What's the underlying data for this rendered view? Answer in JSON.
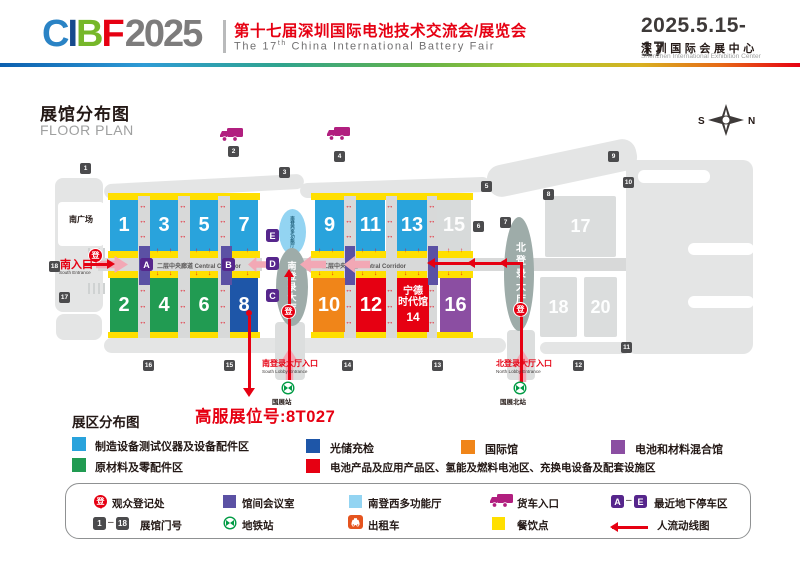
{
  "colors": {
    "brand_red": "#E60012",
    "hall_blue": "#29A3DC",
    "hall_green": "#219B52",
    "hall_dark_blue": "#1E56A8",
    "hall_orange": "#F08519",
    "hall_red": "#E60012",
    "hall_purple": "#8B4EA2",
    "hall_gray": "#DBDDDD",
    "dining_yellow": "#FFDF00",
    "meeting_purple": "#5B51A4",
    "parking_purple": "#56268C",
    "multi_blue": "#93D4F2",
    "metro_green": "#009B44",
    "taxi_orange": "#E5541F",
    "truck_magenta": "#B11F7F",
    "gate_gray": "#4B4B4D",
    "corridor_gray": "#D8D9D9",
    "lobby_gray": "#9EACA9"
  },
  "header": {
    "logo_c": "C",
    "logo_i": "I",
    "logo_b": "B",
    "logo_f": "F",
    "logo_year": "2025",
    "title_cn": "第十七届深圳国际电池技术交流会/展览会",
    "title_en_pre": "The 17",
    "title_en_sup": "th",
    "title_en_post": " China International Battery Fair",
    "dates": "2025.5.15-17",
    "venue_cn": "深圳国际会展中心",
    "venue_en": "Shenzhen International Exhibition Center"
  },
  "floorplan": {
    "title_cn": "展馆分布图",
    "title_en": "FLOOR PLAN",
    "compass_s": "S",
    "compass_n": "N",
    "south_square": "南广场",
    "corridor_left": "二层中央廊道 Central Corridor",
    "corridor_right": "二层中央廊道 Central Corridor",
    "south_lobby": "南登录大厅",
    "north_lobby": "北登录大厅",
    "multi_hall": "南登西多功能厅",
    "reg_glyph": "登",
    "south_entrance_cn": "南入口",
    "south_entrance_en": "South Entrance",
    "south_lobby_entrance_cn": "南登录大厅入口",
    "south_lobby_entrance_en": "South Lobby Entrance",
    "north_lobby_entrance_cn": "北登录大厅入口",
    "north_lobby_entrance_en": "North Lobby Entrance",
    "station_south": "国展站",
    "station_north": "国展北站",
    "booth_callout": "高服展位号:8T027",
    "halls": {
      "h1": "1",
      "h2": "2",
      "h3": "3",
      "h4": "4",
      "h5": "5",
      "h6": "6",
      "h7": "7",
      "h8": "8",
      "h9": "9",
      "h10": "10",
      "h11": "11",
      "h12": "12",
      "h13": "13",
      "h15": "15",
      "h16": "16",
      "h17": "17",
      "h18": "18",
      "h20": "20",
      "h14_l1": "宁德",
      "h14_l2": "时代馆",
      "h14_no": "14"
    },
    "gates": {
      "g1": "1",
      "g2": "2",
      "g3": "3",
      "g4": "4",
      "g5": "5",
      "g6": "6",
      "g7": "7",
      "g8": "8",
      "g9": "9",
      "g10": "10",
      "g11": "11",
      "g12": "12",
      "g13": "13",
      "g14": "14",
      "g15": "15",
      "g16": "16",
      "g17": "17",
      "g18": "18"
    },
    "parking": {
      "a": "A",
      "b": "B",
      "c": "C",
      "d": "D",
      "e": "E"
    }
  },
  "legend": {
    "heading": "展区分布图",
    "zones": [
      {
        "label": "制造设备测试仪器及设备配件区",
        "color": "#29A3DC"
      },
      {
        "label": "光储充检",
        "color": "#1E56A8"
      },
      {
        "label": "国际馆",
        "color": "#F08519"
      },
      {
        "label": "电池和材料混合馆",
        "color": "#8B4EA2"
      },
      {
        "label": "原材料及零配件区",
        "color": "#219B52"
      },
      {
        "label": "电池产品及应用产品区、氢能及燃料电池区、充换电设备及配套设施区",
        "color": "#E60012"
      }
    ]
  },
  "facilities": {
    "registration": "观众登记处",
    "meeting_room": "馆间会议室",
    "multi_hall": "南登西多功能厅",
    "truck_entrance": "货车入口",
    "parking": "最近地下停车区",
    "gate_label": "展馆门号",
    "gate_from": "1",
    "gate_to": "18",
    "metro": "地铁站",
    "taxi": "出租车",
    "dining": "餐饮点",
    "flow": "人流动线图",
    "parking_from": "A",
    "parking_to": "E",
    "reg_glyph": "登"
  }
}
